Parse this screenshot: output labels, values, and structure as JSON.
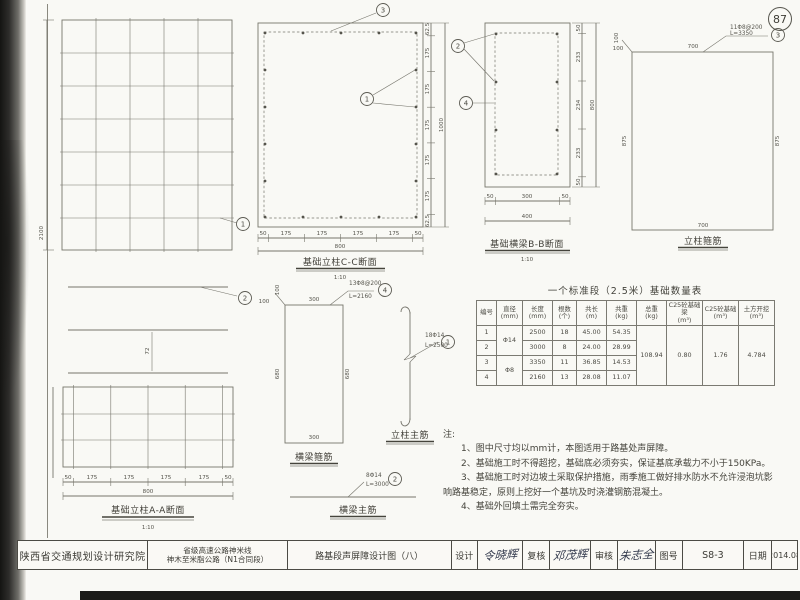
{
  "page_number": "87",
  "aa_upper": {
    "dim_height": "2100",
    "callout": "1"
  },
  "aa_lower": {
    "title": "基础立柱A-A断面",
    "scale": "1:10",
    "callout": "2",
    "dim_mid": "72",
    "dims_bottom": [
      "50",
      "175",
      "175",
      "175",
      "175",
      "50"
    ],
    "dim_total": "800"
  },
  "cc": {
    "title": "基础立柱C-C断面",
    "scale": "1:10",
    "callout_main": "1",
    "callout_stirrup": "3",
    "dims_bottom": [
      "50",
      "175",
      "175",
      "175",
      "175",
      "50"
    ],
    "dim_total_bottom": "800",
    "dims_right": [
      "62.5",
      "175",
      "175",
      "175",
      "175",
      "175",
      "62.5"
    ],
    "dim_total_right": "1000"
  },
  "bb": {
    "title": "基础横梁B-B断面",
    "scale": "1:10",
    "callout_main": "2",
    "callout_stirrup": "4",
    "dims_bottom": [
      "50",
      "300",
      "50"
    ],
    "dim_total_bottom": "400",
    "dims_right": [
      "50",
      "233",
      "234",
      "233",
      "50"
    ],
    "dim_total_right": "800"
  },
  "column_stirrup": {
    "title": "立柱箍筋",
    "spec": "11Φ8@200",
    "length": "L=3350",
    "callout": "3",
    "dim_top": "700",
    "dim_bottom": "700",
    "dim_left": "875",
    "dim_right": "875",
    "hook_v": "100",
    "hook_h": "100"
  },
  "beam_stirrup": {
    "title": "横梁箍筋",
    "spec": "13Φ8@200",
    "length": "L=2160",
    "callout": "4",
    "dim_top": "300",
    "dim_bottom": "300",
    "dim_left": "680",
    "dim_right": "680",
    "hook_v": "100",
    "hook_h": "100"
  },
  "column_rebar": {
    "title": "立柱主筋",
    "spec": "18Φ14",
    "length": "L=2500",
    "callout": "1"
  },
  "beam_rebar": {
    "title": "横梁主筋",
    "spec": "8Φ14",
    "length": "L=3000",
    "callout": "2"
  },
  "table": {
    "title": "一个标准段（2.5米）基础数量表",
    "headers": [
      {
        "t": "编号",
        "u": ""
      },
      {
        "t": "直径",
        "u": "(mm)"
      },
      {
        "t": "长度",
        "u": "(mm)"
      },
      {
        "t": "根数",
        "u": "(个)"
      },
      {
        "t": "共长",
        "u": "(m)"
      },
      {
        "t": "共重",
        "u": "(kg)"
      },
      {
        "t": "总重",
        "u": "(kg)"
      },
      {
        "t": "C25砼基础梁",
        "u": "(m³)"
      },
      {
        "t": "C25砼基础",
        "u": "(m³)"
      },
      {
        "t": "土方开挖",
        "u": "(m³)"
      }
    ],
    "rows": [
      {
        "no": "1",
        "dia": "Φ14",
        "len": "2500",
        "cnt": "18",
        "tlen": "45.00",
        "twt": "54.35"
      },
      {
        "no": "2",
        "len": "3000",
        "cnt": "8",
        "tlen": "24.00",
        "twt": "28.99"
      },
      {
        "no": "3",
        "dia": "Φ8",
        "len": "3350",
        "cnt": "11",
        "tlen": "36.85",
        "twt": "14.53"
      },
      {
        "no": "4",
        "len": "2160",
        "cnt": "13",
        "tlen": "28.08",
        "twt": "11.07"
      }
    ],
    "total_weight": "108.94",
    "c25_beam": "0.80",
    "c25_foundation": "1.76",
    "earthwork": "4.784"
  },
  "notes": {
    "label": "注:",
    "lines": [
      "1、图中尺寸均以mm计，本图适用于路基处声屏障。",
      "2、基础施工时不得超挖，基础底必须夯实，保证基底承载力不小于150KPa。",
      "3、基础施工时对边坡土采取保护措施，雨季施工做好排水防水不允许浸泡坑影",
      "响路基稳定，原则上挖好一个基坑及时浇灌钢筋混凝土。",
      "4、基础外回填土需完全夯实。"
    ]
  },
  "titleblock": {
    "institute": "陕西省交通规划设计研究院",
    "project_line1": "省级高速公路神米线",
    "project_line2": "神木至米脂公路（N1合同段）",
    "sheet_title": "路基段声屏障设计图（八）",
    "design_label": "设计",
    "design_sig": "令晓辉",
    "check_label": "复核",
    "check_sig": "邓茂辉",
    "review_label": "审核",
    "review_sig": "朱志全",
    "drawing_no_label": "图号",
    "drawing_no": "S8-3",
    "date_label": "日期",
    "date": "2014.08"
  }
}
